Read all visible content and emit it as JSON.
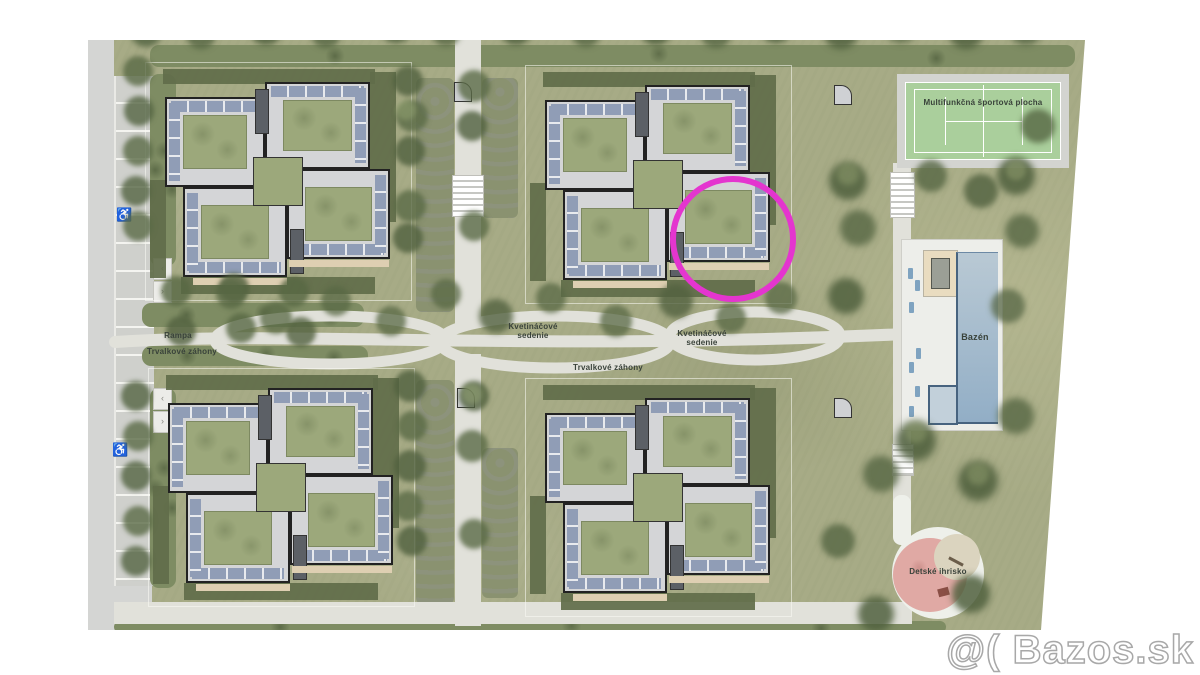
{
  "plan": {
    "labels": {
      "rampa": "Rampa",
      "trvalkove_left": "Trvalkové záhony",
      "kvetinacove_1": "Kvetináčové sedenie",
      "trvalkove_mid": "Trvalkové záhony",
      "kvetinacove_2": "Kvetináčové sedenie",
      "sport_field": "Multifunkčná športová plocha",
      "pool": "Bazén",
      "playground": "Detské ihrisko"
    },
    "icons": {
      "wheelchair": "♿",
      "chevron_left": "‹",
      "chevron_right": "›"
    },
    "highlight": {
      "color": "#e435cf"
    },
    "colors": {
      "grass": "#a7ab86",
      "court_green": "#aacf9c",
      "pool_blue": "#9db8cc",
      "playground_pink": "#e0a9a4",
      "roof_gray": "#d4d5d7",
      "solar_panel_blue": "#909db6",
      "path": "#e1e1da"
    }
  },
  "watermark": {
    "text": "@( Bazos.sk"
  }
}
